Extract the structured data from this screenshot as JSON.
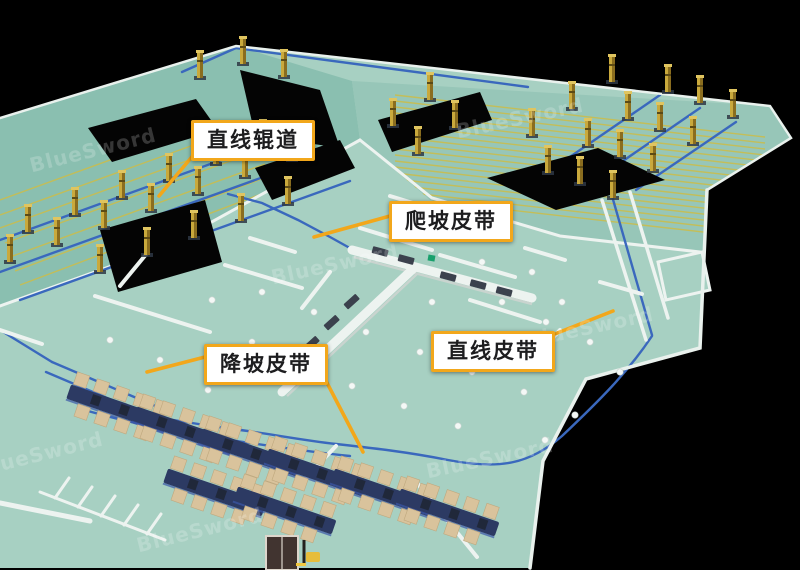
{
  "callouts": {
    "straight_roller": "直线辊道",
    "incline_belt": "爬坡皮带",
    "decline_belt": "降坡皮带",
    "straight_belt": "直线皮带"
  },
  "watermark": "BlueSword",
  "colors": {
    "accent": "#F2A71B",
    "floor": "#A7D0C2",
    "floor_dark": "#8ABFB0",
    "conveyor_blue": "#3A68BD",
    "roller_yellow": "#C9BD4E",
    "tower_gold": "#C9A93C",
    "box_tan": "#D9C39C",
    "machine_navy": "#2C3A63",
    "wall_white": "#EDF3F0",
    "background": "#000000"
  }
}
